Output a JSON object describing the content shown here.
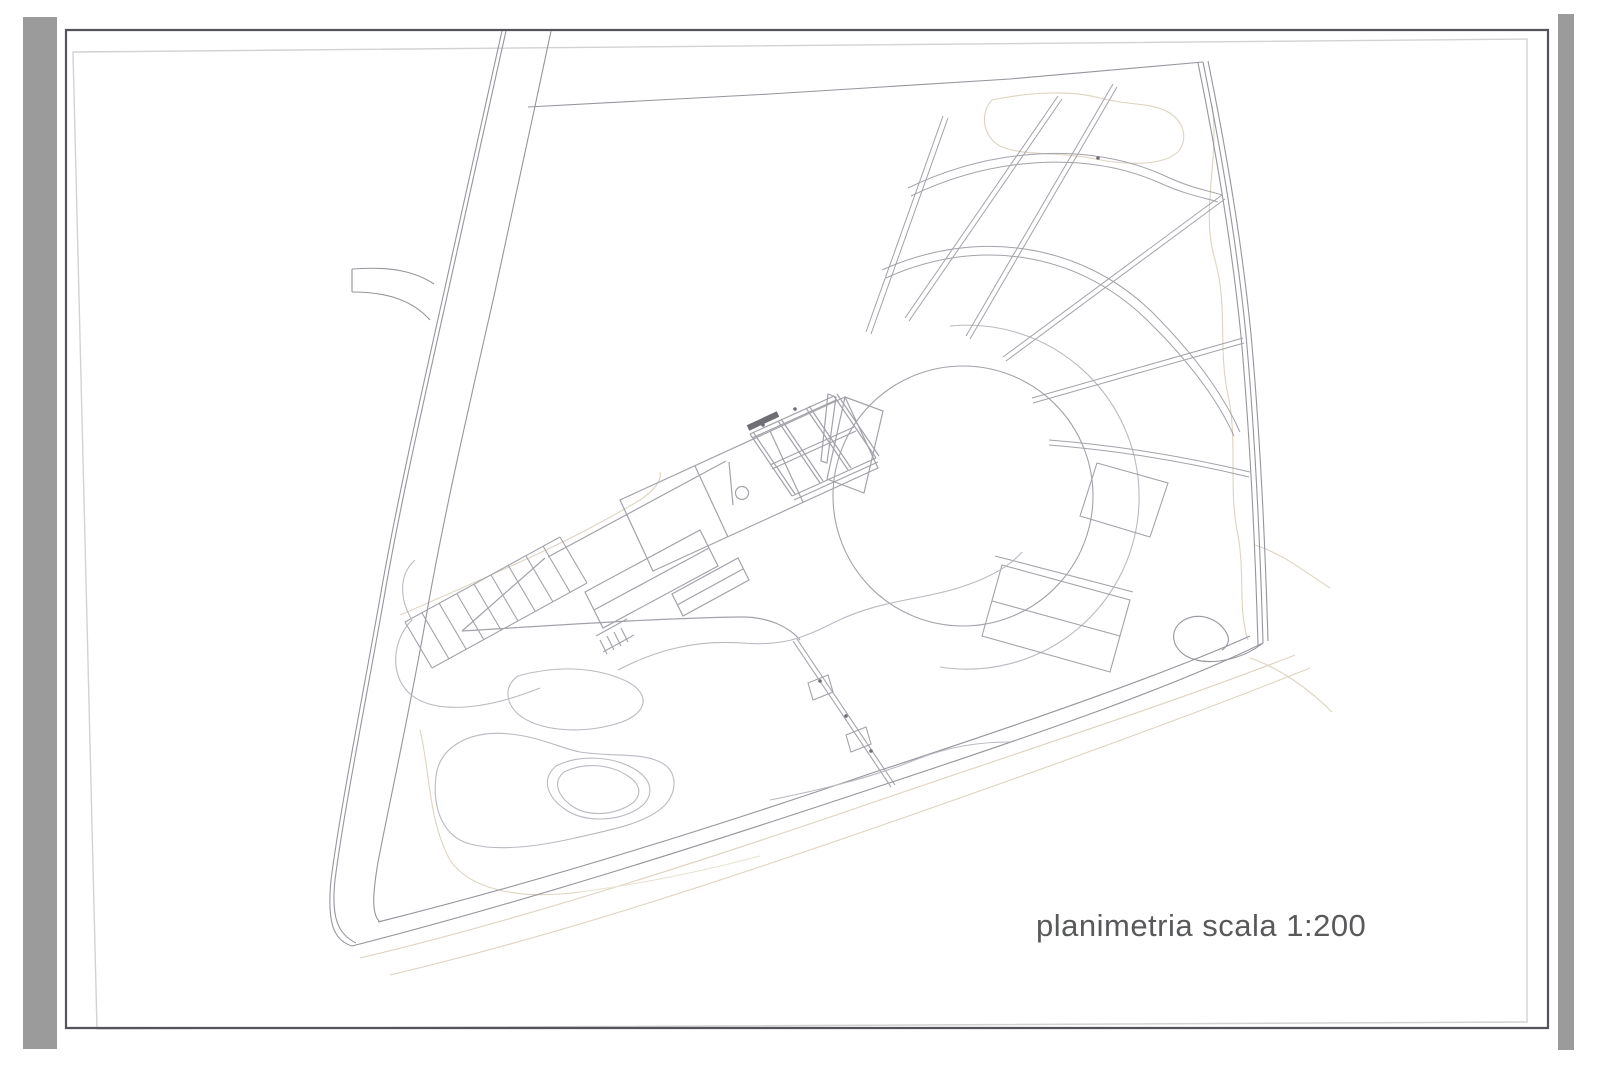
{
  "document": {
    "kind": "architectural site plan sheet",
    "scale_label": "planimetria scala 1:200"
  },
  "colors": {
    "bg": "#ffffff",
    "gutter": "#9b9b9b",
    "frame": "#54555c",
    "paper-edge": "#d2d2d2",
    "line": "#a2a2aa",
    "line-soft": "#b9bac1",
    "road": "#95959d",
    "contour": "#ddd3c1",
    "contour-soft": "#e8e2d4",
    "label": "#58595b",
    "ink": "#6e6e74"
  }
}
